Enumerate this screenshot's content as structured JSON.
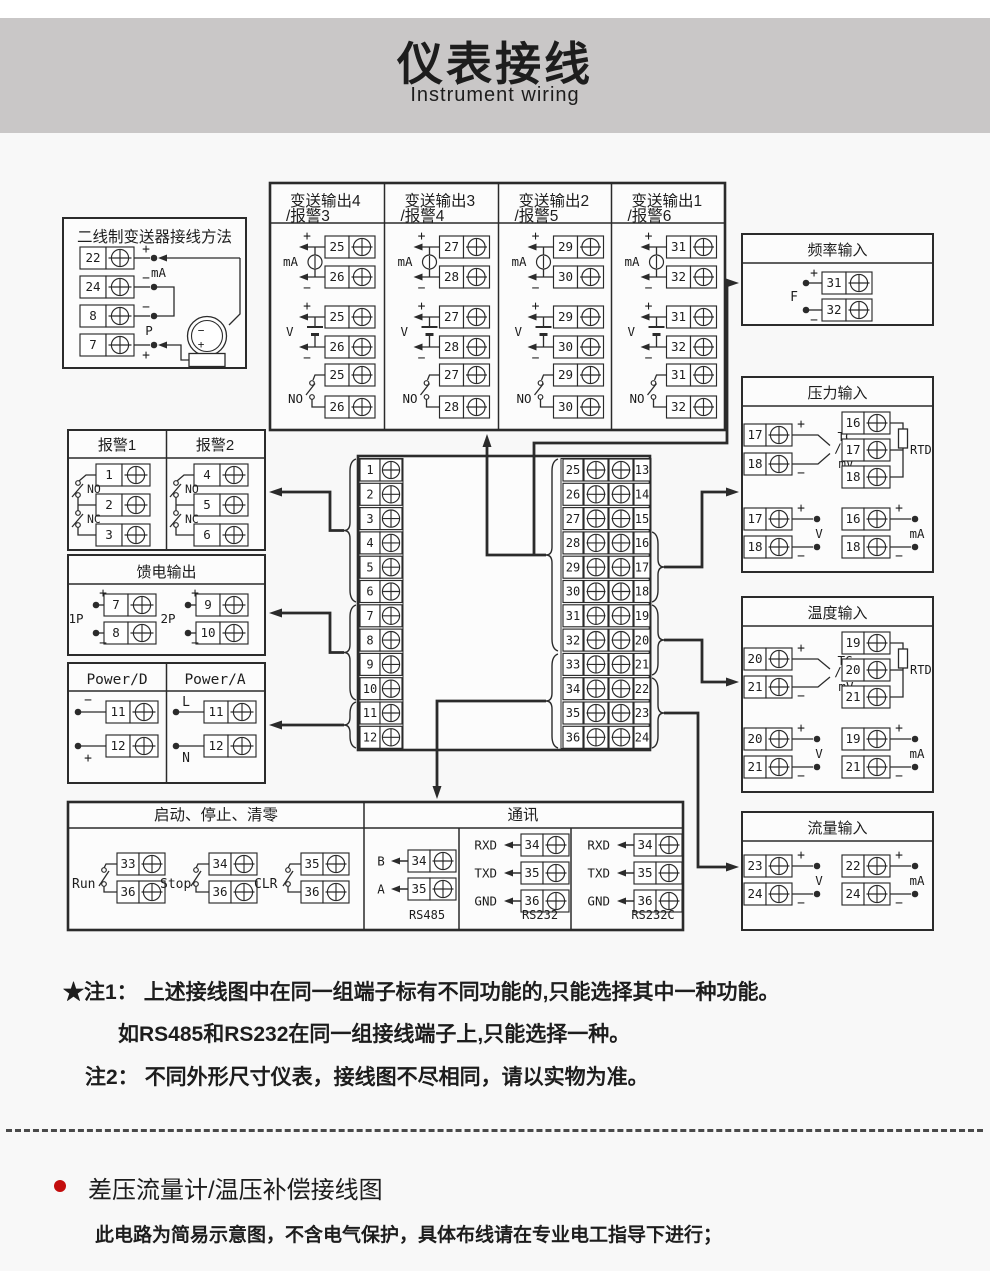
{
  "header": {
    "title": "仪表接线",
    "subtitle": "Instrument wiring"
  },
  "sym": {
    "plus": "+",
    "minus": "−"
  },
  "two_wire": {
    "title": "二线制变送器接线方法",
    "terminals": [
      "22",
      "24",
      "8",
      "7"
    ],
    "labels": {
      "ma": "mA",
      "p": "P"
    }
  },
  "transmit": {
    "columns": [
      {
        "title1": "变送输出4",
        "title2": "/报警3",
        "a": "25",
        "b": "26"
      },
      {
        "title1": "变送输出3",
        "title2": "/报警4",
        "a": "27",
        "b": "28"
      },
      {
        "title1": "变送输出2",
        "title2": "/报警5",
        "a": "29",
        "b": "30"
      },
      {
        "title1": "变送输出1",
        "title2": "/报警6",
        "a": "31",
        "b": "32"
      }
    ],
    "labels": {
      "ma": "mA",
      "v": "V",
      "no": "NO"
    }
  },
  "freq": {
    "title": "频率输入",
    "f": "F",
    "a": "31",
    "b": "32"
  },
  "pressure": {
    "title": "压力输入",
    "tc": {
      "a": "17",
      "b": "18",
      "l1": "TC",
      "l2": "/",
      "l3": "mV"
    },
    "rtd": {
      "a": "16",
      "b": "17",
      "c": "18",
      "label": "RTD"
    },
    "v": {
      "a": "17",
      "b": "18",
      "label": "V"
    },
    "ma": {
      "a": "16",
      "b": "18",
      "label": "mA"
    }
  },
  "temperature": {
    "title": "温度输入",
    "tc": {
      "a": "20",
      "b": "21",
      "l1": "TC",
      "l2": "/",
      "l3": "mV"
    },
    "rtd": {
      "a": "19",
      "b": "20",
      "c": "21",
      "label": "RTD"
    },
    "v": {
      "a": "20",
      "b": "21",
      "label": "V"
    },
    "ma": {
      "a": "19",
      "b": "21",
      "label": "mA"
    }
  },
  "flow": {
    "title": "流量输入",
    "v": {
      "a": "23",
      "b": "24",
      "label": "V"
    },
    "ma": {
      "a": "22",
      "b": "24",
      "label": "mA"
    }
  },
  "alarm": {
    "title1": "报警1",
    "title2": "报警2",
    "g1": [
      "1",
      "2",
      "3"
    ],
    "g2": [
      "4",
      "5",
      "6"
    ],
    "no": "NO",
    "nc": "NC"
  },
  "feed": {
    "title": "馈电输出",
    "g1": {
      "label": "1P",
      "a": "7",
      "b": "8"
    },
    "g2": {
      "label": "2P",
      "a": "9",
      "b": "10"
    }
  },
  "power": {
    "title1": "Power/D",
    "title2": "Power/A",
    "d": {
      "a": "11",
      "b": "12",
      "la": "−",
      "lb": "+"
    },
    "ac": {
      "a": "11",
      "b": "12",
      "la": "L",
      "lb": "N"
    }
  },
  "center": {
    "left": [
      "1",
      "2",
      "3",
      "4",
      "5",
      "6",
      "7",
      "8",
      "9",
      "10",
      "11",
      "12"
    ],
    "mid": [
      "25",
      "26",
      "27",
      "28",
      "29",
      "30",
      "31",
      "32",
      "33",
      "34",
      "35",
      "36"
    ],
    "right": [
      "13",
      "14",
      "15",
      "16",
      "17",
      "18",
      "19",
      "20",
      "21",
      "22",
      "23",
      "24"
    ]
  },
  "control": {
    "title": "启动、停止、清零",
    "groups": [
      {
        "label": "Run",
        "a": "33",
        "b": "36"
      },
      {
        "label": "Stop",
        "a": "34",
        "b": "36"
      },
      {
        "label": "CLR",
        "a": "35",
        "b": "36"
      }
    ]
  },
  "comm": {
    "title": "通讯",
    "rs485": {
      "label": "RS485",
      "rows": [
        {
          "l": "B",
          "n": "34"
        },
        {
          "l": "A",
          "n": "35"
        }
      ]
    },
    "rs232": {
      "label": "RS232",
      "rows": [
        {
          "l": "RXD",
          "n": "34"
        },
        {
          "l": "TXD",
          "n": "35"
        },
        {
          "l": "GND",
          "n": "36"
        }
      ]
    },
    "rs232c": {
      "label": "RS232C",
      "rows": [
        {
          "l": "RXD",
          "n": "34"
        },
        {
          "l": "TXD",
          "n": "35"
        },
        {
          "l": "GND",
          "n": "36"
        }
      ]
    }
  },
  "notes": {
    "n1_head": "★注1：",
    "n1_line1": "上述接线图中在同一组端子标有不同功能的,只能选择其中一种功能。",
    "n1_line2": "如RS485和RS232在同一组接线端子上,只能选择一种。",
    "n2_head": "注2：",
    "n2_line": "不同外形尺寸仪表，接线图不尽相同，请以实物为准。"
  },
  "footer": {
    "heading": "差压流量计/温压补偿接线图",
    "note": "此电路为简易示意图，不含电气保护，具体布线请在专业电工指导下进行；"
  },
  "colors": {
    "banner": "#c9c7c7",
    "ink": "#1d1d1d",
    "line": "#2b2b2b",
    "red": "#c30d0d",
    "page_bg": "#f8f8f8",
    "box_bg": "#fcfcfc"
  }
}
